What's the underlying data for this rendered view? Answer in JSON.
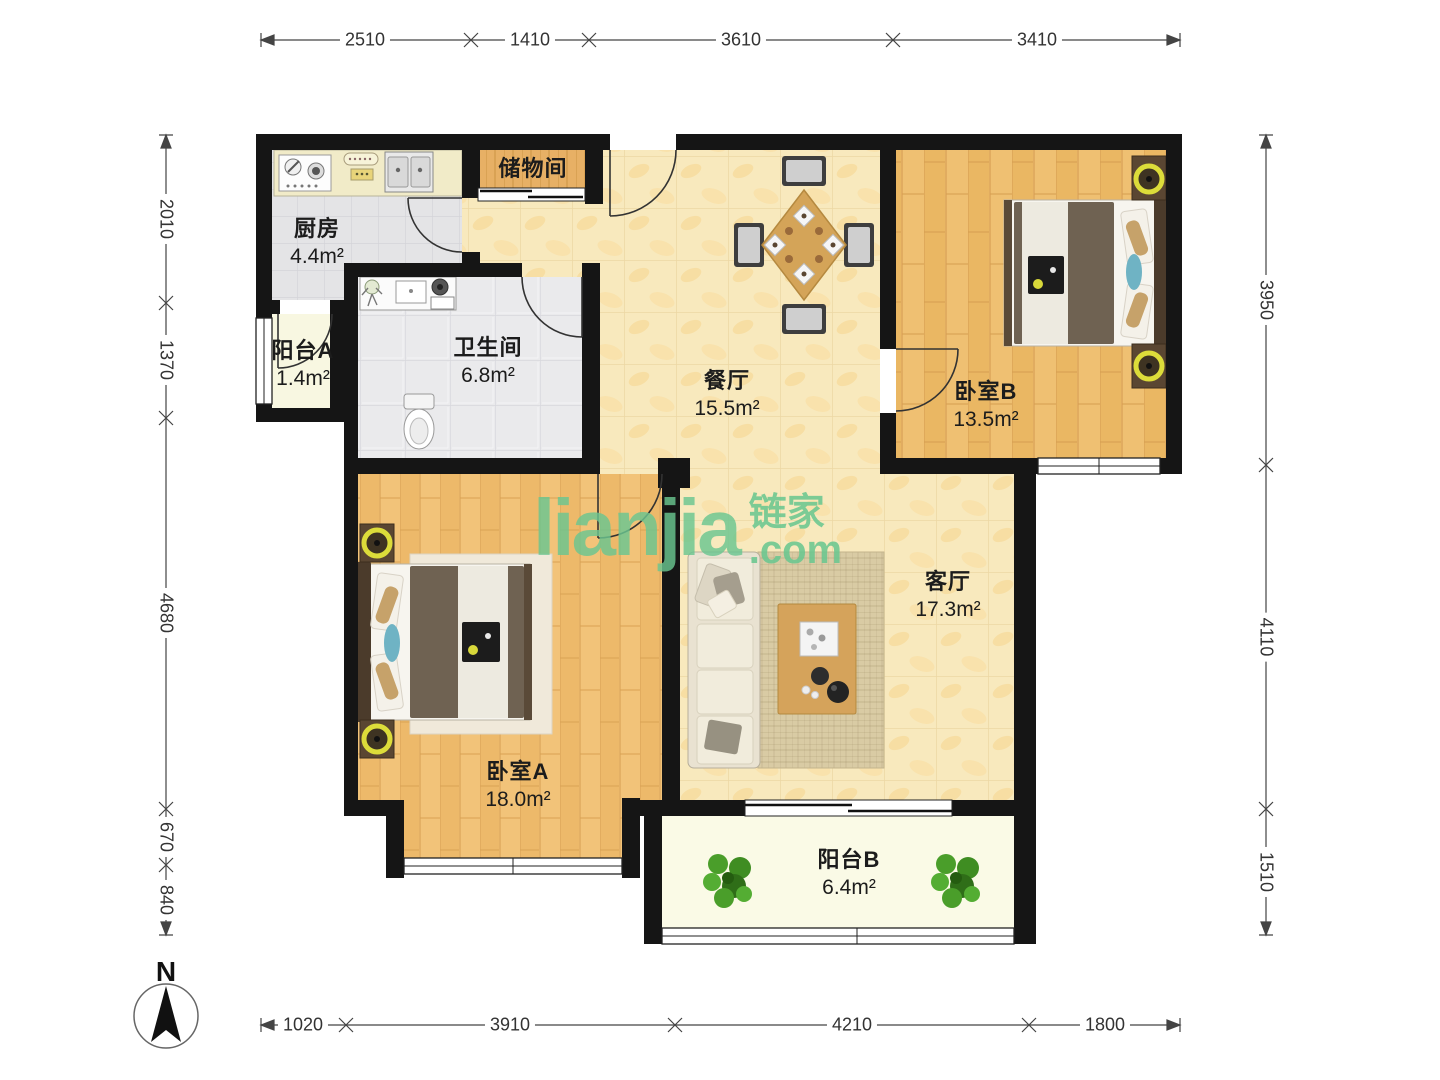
{
  "watermark": {
    "brand_latin": "lianjia",
    "brand_cn": "链家",
    "brand_domain": ".com"
  },
  "compass": {
    "north_label": "N"
  },
  "rooms": [
    {
      "key": "kitchen",
      "name": "厨房",
      "area": "4.4m²"
    },
    {
      "key": "storage",
      "name": "储物间",
      "area": ""
    },
    {
      "key": "balcony_a",
      "name": "阳台A",
      "area": "1.4m²"
    },
    {
      "key": "bathroom",
      "name": "卫生间",
      "area": "6.8m²"
    },
    {
      "key": "dining",
      "name": "餐厅",
      "area": "15.5m²"
    },
    {
      "key": "bedroom_b",
      "name": "卧室B",
      "area": "13.5m²"
    },
    {
      "key": "bedroom_a",
      "name": "卧室A",
      "area": "18.0m²"
    },
    {
      "key": "living",
      "name": "客厅",
      "area": "17.3m²"
    },
    {
      "key": "balcony_b",
      "name": "阳台B",
      "area": "6.4m²"
    }
  ],
  "dimensions_mm": {
    "top": [
      "2510",
      "1410",
      "3610",
      "3410"
    ],
    "bottom": [
      "1020",
      "3910",
      "4210",
      "1800"
    ],
    "left": [
      "2010",
      "1370",
      "4680",
      "670",
      "840"
    ],
    "right": [
      "3950",
      "4110",
      "1510"
    ]
  },
  "colors": {
    "wall": "#151515",
    "watermark_green": "#6ac690",
    "wood_floor": "#f2c379",
    "marble_tile": "#f8e9bd",
    "kitchen_tile": "#e4e4e6",
    "balcony_floor": "#f8f7e1"
  }
}
